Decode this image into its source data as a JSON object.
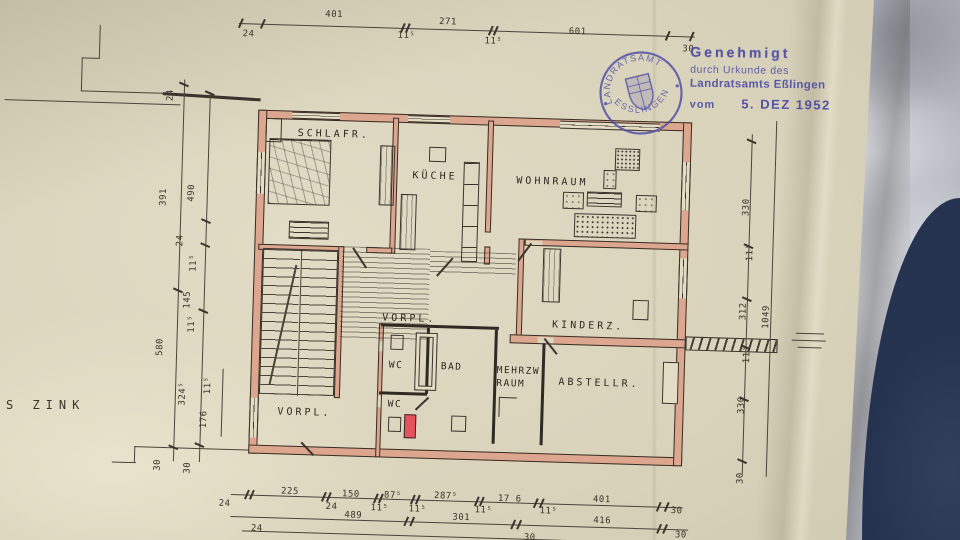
{
  "approval_stamp": {
    "line1": "Genehmigt",
    "line2": "durch Urkunde des",
    "line3": "Landratsamts Eßlingen",
    "vom_label": "vom",
    "date": "5. DEZ 1952"
  },
  "seal": {
    "arc_top": "LANDRATSAMT",
    "arc_bottom": "ESSLINGEN"
  },
  "annotations": {
    "architect": "S ZINK"
  },
  "rooms": {
    "schlafr": "SCHLAFR.",
    "kueche": "KÜCHE",
    "wohnraum": "WOHNRAUM",
    "vorpl_mid": "VORPL.",
    "kinderz": "KINDERZ.",
    "wc_upper": "WC",
    "bad": "BAD",
    "mehrzw_line1": "MEHRZW-",
    "mehrzw_line2": "RAUM",
    "wc_lower": "WC",
    "abstellr": "ABSTELLR.",
    "vorpl_lower": "VORPL."
  },
  "dimensions": {
    "top": [
      "24",
      "401",
      "11⁵",
      "271",
      "11⁵",
      "601",
      "30"
    ],
    "bottom_row1": [
      "24",
      "225",
      "24",
      "150",
      "11⁵",
      "87⁵",
      "11⁵",
      "287⁵",
      "11⁵",
      "17 6",
      "11⁵",
      "401",
      "30"
    ],
    "bottom_row2": [
      "489",
      "301",
      "416",
      "30"
    ],
    "bottom_row3": [
      "24",
      "30"
    ],
    "left_outer": [
      "24",
      "391",
      "580",
      "30"
    ],
    "left_inner": [
      "490",
      "24",
      "11⁵",
      "145",
      "11⁵",
      "324⁵",
      "30"
    ],
    "left_detail": [
      "11⁵",
      "176"
    ],
    "right_inner": [
      "330",
      "11⁵",
      "312",
      "11⁵",
      "330",
      "30"
    ],
    "right_outer": [
      "1049"
    ]
  },
  "colors": {
    "paper": "#d9d3bc",
    "wall_fill": "#dca68f",
    "drawing_ink": "#352e26",
    "stamp_ink": "#4c4ba3",
    "chimney_red": "#e6535e",
    "fabric_navy": "#2c3852",
    "table_grey": "#b4b7bf"
  }
}
